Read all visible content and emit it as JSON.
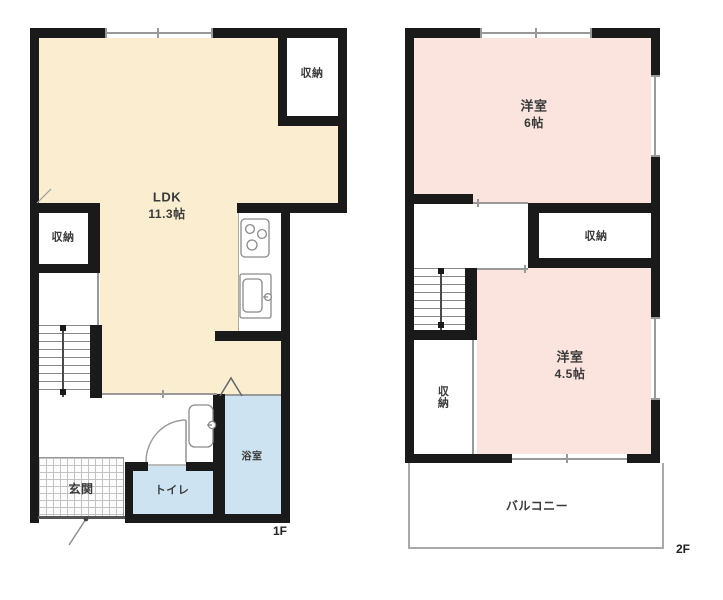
{
  "figure": {
    "type": "floor-plan",
    "floors_count": 2
  },
  "floor1": {
    "marker": "1F",
    "ldk_name": "LDK",
    "ldk_size": "11.3帖",
    "closet_top": "収納",
    "closet_left": "収納",
    "entrance": "玄関",
    "toilet": "トイレ",
    "bath": "浴室"
  },
  "floor2": {
    "marker": "2F",
    "bedroom1_name": "洋室",
    "bedroom1_size": "6帖",
    "closet_hall": "収納",
    "closet_lower": "収納",
    "bedroom2_name": "洋室",
    "bedroom2_size": "4.5帖",
    "balcony": "バルコニー"
  },
  "colors": {
    "ldk": "#FBEDD0",
    "bedroom_pink": "#FAE4DD",
    "water_blue": "#CDE3F1",
    "wall_black": "#1a1a1a",
    "line_gray": "#999999"
  }
}
